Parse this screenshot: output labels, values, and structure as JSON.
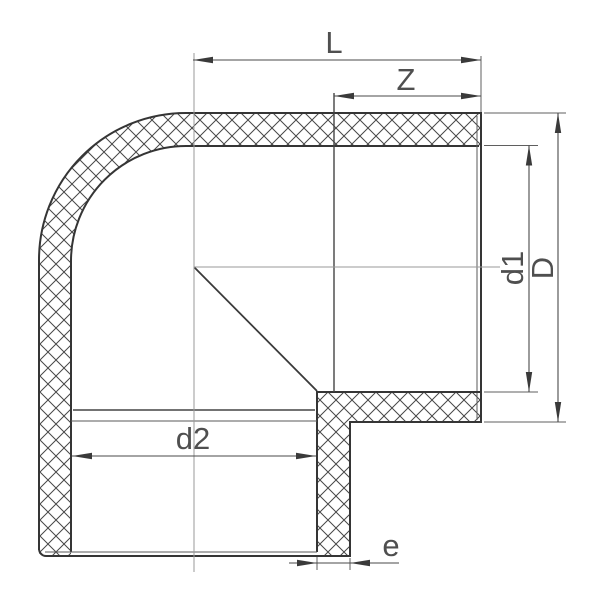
{
  "labels": {
    "L": "L",
    "Z": "Z",
    "d1": "d1",
    "D": "D",
    "d2": "d2",
    "e": "e"
  },
  "colors": {
    "background": "#ffffff",
    "body_line": "#353535",
    "hatch": "#474747",
    "dimension_line": "#4a4a4a",
    "dimension_text": "#4f4f4f",
    "centerline": "#9a9a9a"
  }
}
